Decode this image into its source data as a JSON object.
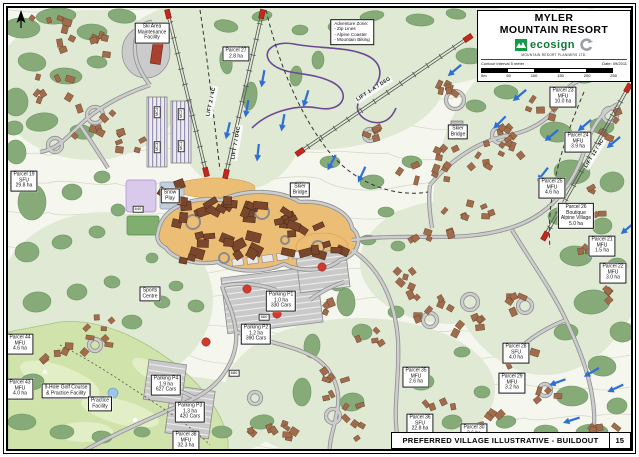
{
  "title_block": {
    "resort_line1": "MYLER",
    "resort_line2": "MOUNTAIN RESORT",
    "logo_text": "ecosign",
    "logo_subtext": "MOUNTAIN RESORT PLANNERS LTD.",
    "contour_note": "Contour Interval 5 meter",
    "date_label": "Date: 09/2011",
    "scale_ticks": [
      "0m",
      "50",
      "100",
      "150",
      "200",
      "250"
    ]
  },
  "footer": {
    "title": "PREFERRED VILLAGE ILLUSTRATIVE - BUILDOUT",
    "page_number": "15"
  },
  "colors": {
    "forest_green": "#86ab78",
    "village_tan": "#ecbe75",
    "arrow_blue": "#2e6fd6",
    "marker_red": "#d23a2e",
    "logo_green": "#0e9c44"
  },
  "map_labels": [
    {
      "name": "label-ski-area-maintenance-facility",
      "cls": "box",
      "x": 152,
      "y": 33,
      "rot": 0,
      "lines": [
        "Ski Area",
        "Maintenance",
        "Facility"
      ]
    },
    {
      "name": "label-adventure-zone",
      "cls": "note",
      "x": 352,
      "y": 32,
      "rot": 0,
      "lines": [
        "Adventure Zone:",
        "- Zip Lines",
        "- Alpine Coaster",
        "- Mountain Biking"
      ]
    },
    {
      "name": "label-parcel-27",
      "cls": "box",
      "x": 236,
      "y": 54,
      "rot": 0,
      "lines": [
        "Parcel 27",
        "2.8 ha"
      ]
    },
    {
      "name": "label-lift-2",
      "cls": "lift",
      "x": 212,
      "y": 102,
      "rot": -78,
      "lines": [
        "LIFT 2 / 4C"
      ]
    },
    {
      "name": "label-lift-7",
      "cls": "lift",
      "x": 237,
      "y": 143,
      "rot": -80,
      "lines": [
        "LIFT 7 / D4C"
      ]
    },
    {
      "name": "label-lift-1a",
      "cls": "lift",
      "x": 374,
      "y": 90,
      "rot": -33,
      "lines": [
        "LIFT 1-A / D6G"
      ]
    },
    {
      "name": "label-lift-12",
      "cls": "lift",
      "x": 595,
      "y": 154,
      "rot": -58,
      "lines": [
        "LIFT 12 / 4C"
      ]
    },
    {
      "name": "label-lot-mc4",
      "cls": "tiny",
      "x": 157,
      "y": 112,
      "rot": -90,
      "lines": [
        "MC4"
      ]
    },
    {
      "name": "label-lot-mc3",
      "cls": "tiny",
      "x": 157,
      "y": 147,
      "rot": -90,
      "lines": [
        "MC3"
      ]
    },
    {
      "name": "label-lot-mc2",
      "cls": "tiny",
      "x": 181,
      "y": 114,
      "rot": -90,
      "lines": [
        "MC2"
      ]
    },
    {
      "name": "label-lot-mc1",
      "cls": "tiny",
      "x": 181,
      "y": 146,
      "rot": -90,
      "lines": [
        "MC1"
      ]
    },
    {
      "name": "label-snow-play",
      "cls": "box",
      "x": 170,
      "y": 196,
      "rot": 0,
      "lines": [
        "Snow",
        "Play"
      ]
    },
    {
      "name": "label-road-640",
      "cls": "tiny",
      "x": 138,
      "y": 209,
      "rot": 0,
      "lines": [
        "640"
      ]
    },
    {
      "name": "label-skier-bridge-west",
      "cls": "box",
      "x": 300,
      "y": 190,
      "rot": 0,
      "lines": [
        "Skier",
        "Bridge"
      ]
    },
    {
      "name": "label-skier-bridge-east",
      "cls": "box",
      "x": 458,
      "y": 132,
      "rot": 0,
      "lines": [
        "Skier",
        "Bridge"
      ]
    },
    {
      "name": "label-parcel-23",
      "cls": "box",
      "x": 563,
      "y": 97,
      "rot": 0,
      "lines": [
        "Parcel 23",
        "MFU",
        "10.0 ha"
      ]
    },
    {
      "name": "label-parcel-24",
      "cls": "box",
      "x": 578,
      "y": 142,
      "rot": 0,
      "lines": [
        "Parcel 24",
        "MFU",
        "3.9 ha"
      ]
    },
    {
      "name": "label-parcel-25",
      "cls": "box",
      "x": 552,
      "y": 188,
      "rot": 0,
      "lines": [
        "Parcel 25",
        "MFU",
        "4.6 ha"
      ]
    },
    {
      "name": "label-parcel-26",
      "cls": "box",
      "x": 576,
      "y": 216,
      "rot": 0,
      "lines": [
        "Parcel 26",
        "Boutique",
        "Alpine Village",
        "5.0 ha"
      ]
    },
    {
      "name": "label-parcel-21",
      "cls": "box",
      "x": 602,
      "y": 246,
      "rot": 0,
      "lines": [
        "Parcel 21",
        "MFU",
        "1.5 ha"
      ]
    },
    {
      "name": "label-parcel-22",
      "cls": "box",
      "x": 613,
      "y": 273,
      "rot": 0,
      "lines": [
        "Parcel 22",
        "MFU",
        "3.0 ha"
      ]
    },
    {
      "name": "label-parcel-19",
      "cls": "box",
      "x": 24,
      "y": 181,
      "rot": 0,
      "lines": [
        "Parcel 19",
        "SFU",
        "29.8 ha"
      ]
    },
    {
      "name": "label-parcel-44",
      "cls": "box",
      "x": 20,
      "y": 344,
      "rot": 0,
      "lines": [
        "Parcel 44",
        "MFU",
        "4.6 ha"
      ]
    },
    {
      "name": "label-parcel-43",
      "cls": "box",
      "x": 20,
      "y": 389,
      "rot": 0,
      "lines": [
        "Parcel 43",
        "MFU",
        "4.0 ha"
      ]
    },
    {
      "name": "label-golf-course",
      "cls": "box",
      "x": 66,
      "y": 391,
      "rot": 0,
      "lines": [
        "9-Hole Golf Course",
        "& Practice Facility"
      ]
    },
    {
      "name": "label-practice-facility",
      "cls": "box",
      "x": 100,
      "y": 404,
      "rot": 0,
      "lines": [
        "Practice",
        "Facility"
      ]
    },
    {
      "name": "label-sports-centre",
      "cls": "box",
      "x": 150,
      "y": 294,
      "rot": 0,
      "lines": [
        "Sports",
        "Centre"
      ]
    },
    {
      "name": "label-parking-p4",
      "cls": "box",
      "x": 166,
      "y": 385,
      "rot": 0,
      "lines": [
        "Parking P4",
        "1.9 ha",
        "627 Cars"
      ]
    },
    {
      "name": "label-parking-p3",
      "cls": "box",
      "x": 190,
      "y": 412,
      "rot": 0,
      "lines": [
        "Parking P3",
        "1.3 ha",
        "420 Cars"
      ]
    },
    {
      "name": "label-parcel-38",
      "cls": "box",
      "x": 186,
      "y": 441,
      "rot": 0,
      "lines": [
        "Parcel 38",
        "MFU",
        "32.3 ha"
      ]
    },
    {
      "name": "label-road-680",
      "cls": "tiny",
      "x": 234,
      "y": 373,
      "rot": 0,
      "lines": [
        "680"
      ]
    },
    {
      "name": "label-road-660",
      "cls": "tiny",
      "x": 264,
      "y": 317,
      "rot": 0,
      "lines": [
        "660"
      ]
    },
    {
      "name": "label-parking-p1",
      "cls": "box",
      "x": 281,
      "y": 301,
      "rot": 0,
      "lines": [
        "Parking P1",
        "1.0 ha",
        "330 Cars"
      ]
    },
    {
      "name": "label-parking-p2",
      "cls": "box",
      "x": 256,
      "y": 334,
      "rot": 0,
      "lines": [
        "Parking P2",
        "1.2 ha",
        "390 Cars"
      ]
    },
    {
      "name": "label-parcel-35",
      "cls": "box",
      "x": 416,
      "y": 377,
      "rot": 0,
      "lines": [
        "Parcel 35",
        "MFU",
        "2.6 ha"
      ]
    },
    {
      "name": "label-parcel-36",
      "cls": "box",
      "x": 420,
      "y": 424,
      "rot": 0,
      "lines": [
        "Parcel 36",
        "SFU",
        "22.8 ha"
      ]
    },
    {
      "name": "label-parcel-30",
      "cls": "box",
      "x": 474,
      "y": 431,
      "rot": 0,
      "lines": [
        "Parcel 30",
        "2.6 ha"
      ]
    },
    {
      "name": "label-parcel-29",
      "cls": "box",
      "x": 512,
      "y": 383,
      "rot": 0,
      "lines": [
        "Parcel 29",
        "MFU",
        "3.2 ha"
      ]
    },
    {
      "name": "label-parcel-28",
      "cls": "box",
      "x": 516,
      "y": 353,
      "rot": 0,
      "lines": [
        "Parcel 28",
        "SFU",
        "4.0 ha"
      ]
    }
  ],
  "ski_run_arrows": [
    {
      "x": 263,
      "y": 78,
      "a": 100
    },
    {
      "x": 247,
      "y": 108,
      "a": 100
    },
    {
      "x": 228,
      "y": 130,
      "a": 103
    },
    {
      "x": 283,
      "y": 122,
      "a": 100
    },
    {
      "x": 258,
      "y": 152,
      "a": 96
    },
    {
      "x": 306,
      "y": 98,
      "a": 107
    },
    {
      "x": 332,
      "y": 162,
      "a": 118
    },
    {
      "x": 362,
      "y": 174,
      "a": 115
    },
    {
      "x": 455,
      "y": 70,
      "a": 140
    },
    {
      "x": 487,
      "y": 58,
      "a": 135
    },
    {
      "x": 520,
      "y": 95,
      "a": 140
    },
    {
      "x": 500,
      "y": 122,
      "a": 135
    },
    {
      "x": 552,
      "y": 135,
      "a": 140
    },
    {
      "x": 543,
      "y": 174,
      "a": 128
    },
    {
      "x": 585,
      "y": 125,
      "a": 140
    },
    {
      "x": 614,
      "y": 142,
      "a": 140
    },
    {
      "x": 624,
      "y": 62,
      "a": 135
    },
    {
      "x": 497,
      "y": 47,
      "a": 140
    },
    {
      "x": 628,
      "y": 228,
      "a": 140
    },
    {
      "x": 558,
      "y": 382,
      "a": 160
    },
    {
      "x": 592,
      "y": 372,
      "a": 150
    },
    {
      "x": 616,
      "y": 388,
      "a": 155
    },
    {
      "x": 572,
      "y": 420,
      "a": 162
    }
  ],
  "village_markers": [
    {
      "x": 247,
      "y": 289
    },
    {
      "x": 277,
      "y": 314
    },
    {
      "x": 206,
      "y": 342
    },
    {
      "x": 322,
      "y": 267
    }
  ]
}
